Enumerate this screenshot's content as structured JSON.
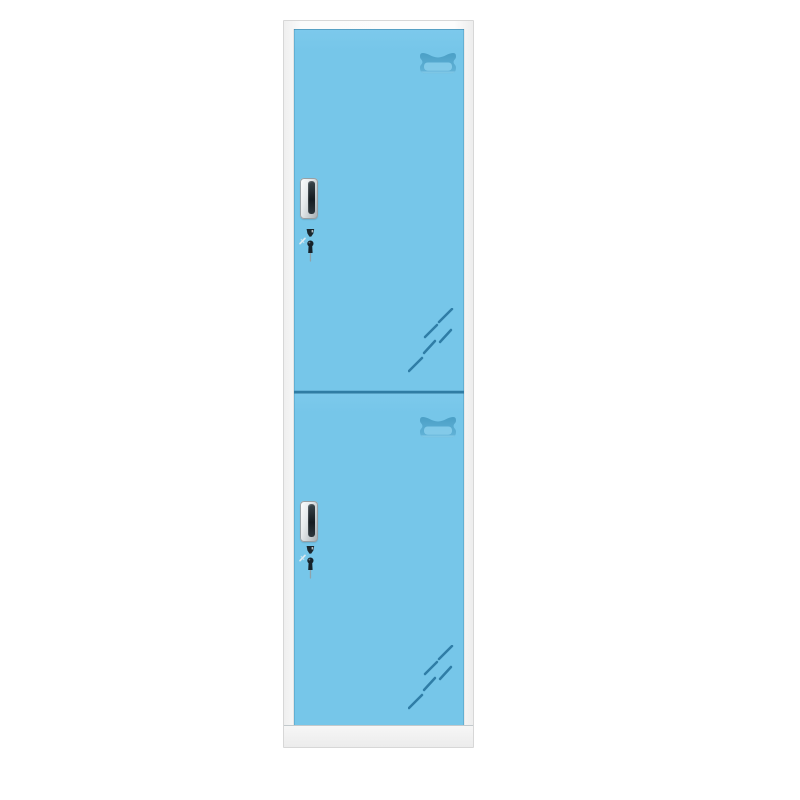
{
  "image": {
    "type": "product-photo",
    "subject": "Two-door vertical steel storage locker",
    "description": "Front view of a tall narrow metal locker with a white frame and two sky-blue doors; each door has a stamped vent grille at top right, a recessed metal handle with key lock on the left, and diagonal gloss reflection marks at bottom right.",
    "door_count": 2
  },
  "colors": {
    "background": "#ffffff",
    "frame": "#fbfbfb",
    "frame-border": "#d7d7d7",
    "door-blue": "#76c6e9",
    "door-edge": "#2f7ca4",
    "divider": "#2f7ca4",
    "vent-dark": "#54a9d0",
    "vent-light": "#85cbea",
    "shine": "#2f7da6",
    "plinth": "#f0f0f0",
    "handle-frame": "#c3cacd",
    "handle-slot": "#141c21",
    "key-dark": "#1a262c",
    "key-stem": "#8fa3ab",
    "sparkle": "#d9e9f1"
  },
  "components": {
    "upper_door": {
      "label": "upper door",
      "features": [
        "vent grille",
        "recessed handle",
        "key lock with key",
        "gloss shine marks"
      ]
    },
    "lower_door": {
      "label": "lower door",
      "features": [
        "vent grille",
        "recessed handle",
        "key lock with key",
        "gloss shine marks"
      ]
    }
  }
}
